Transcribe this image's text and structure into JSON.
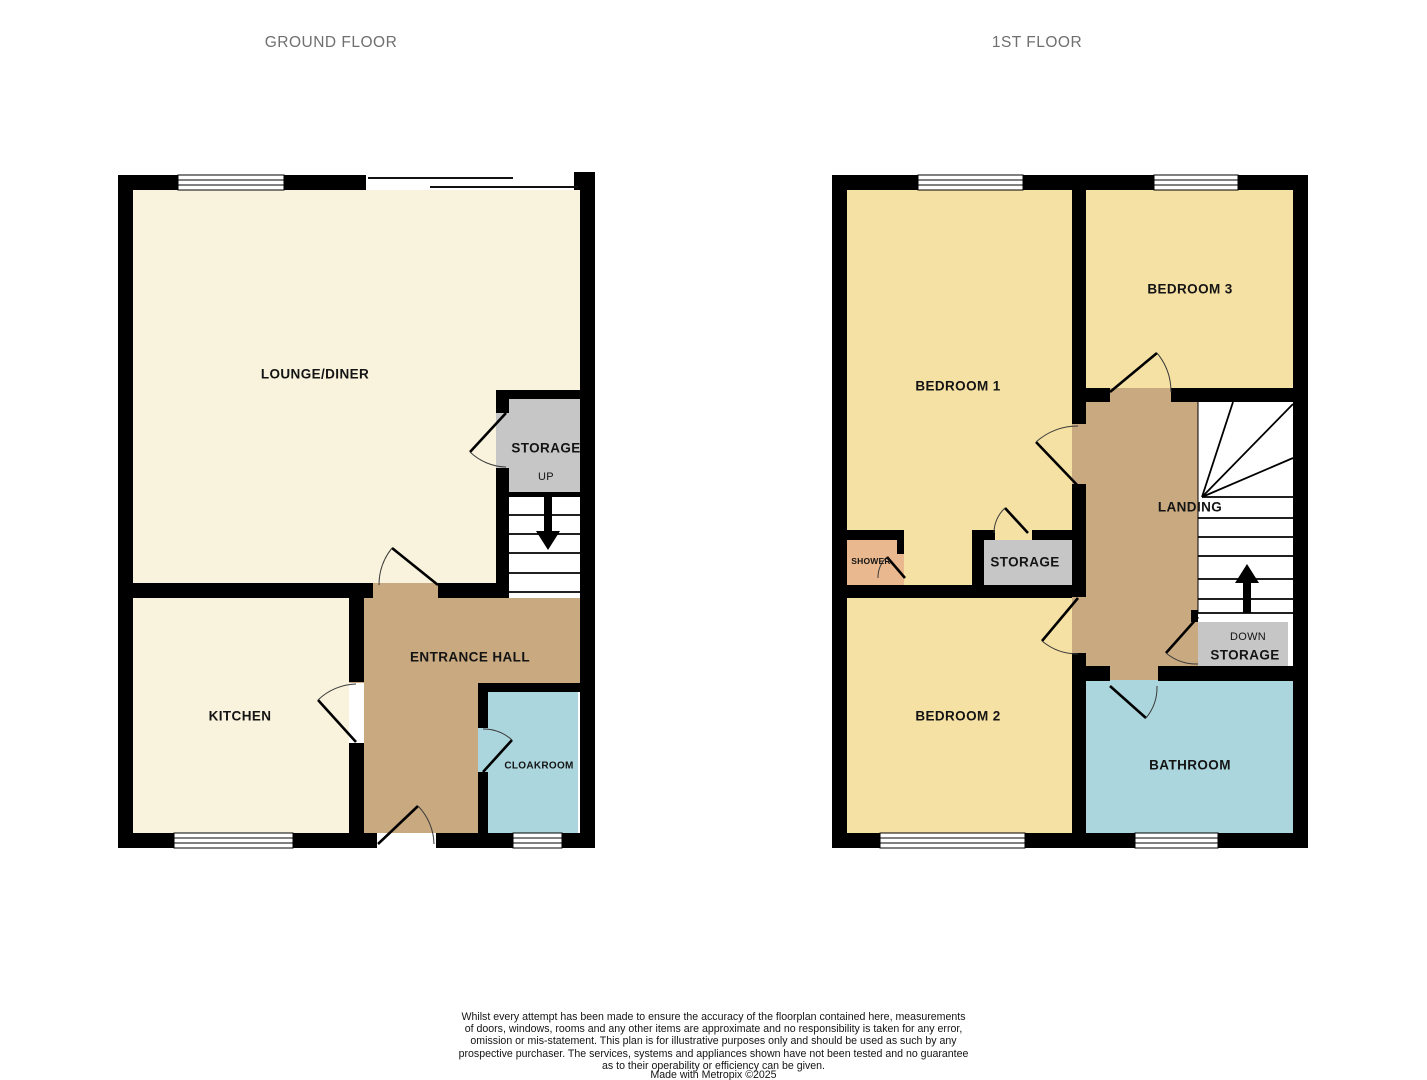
{
  "titles": {
    "ground": "GROUND FLOOR",
    "first": "1ST FLOOR"
  },
  "ground_floor": {
    "rooms": {
      "lounge": "LOUNGE/DINER",
      "kitchen": "KITCHEN",
      "hall": "ENTRANCE HALL",
      "cloakroom": "CLOAKROOM",
      "storage": "STORAGE",
      "up": "UP"
    }
  },
  "first_floor": {
    "rooms": {
      "bedroom1": "BEDROOM 1",
      "bedroom2": "BEDROOM 2",
      "bedroom3": "BEDROOM 3",
      "bathroom": "BATHROOM",
      "landing": "LANDING",
      "shower": "SHOWER",
      "storage": "STORAGE",
      "down": "DOWN",
      "storage_down": "STORAGE"
    }
  },
  "colors": {
    "wall": "#000000",
    "cream": "#f9f3dd",
    "yellow": "#f6e1a4",
    "tan": "#c9a980",
    "blue": "#abd6dd",
    "gray": "#c6c6c6",
    "orange": "#eab88e",
    "titlegray": "#6f6f6f",
    "labeldark": "#141414"
  },
  "disclaimer": {
    "text": "Whilst every attempt has been made to ensure the accuracy of the floorplan contained here, measurements\nof doors, windows, rooms and any other items are approximate and no responsibility is taken for any error,\nomission or mis-statement. This plan is for illustrative purposes only and should be used as such by any\nprospective purchaser. The services, systems and appliances shown have not been tested and no guarantee\nas to their operability or efficiency can be given.",
    "credit": "Made with Metropix ©2025"
  }
}
